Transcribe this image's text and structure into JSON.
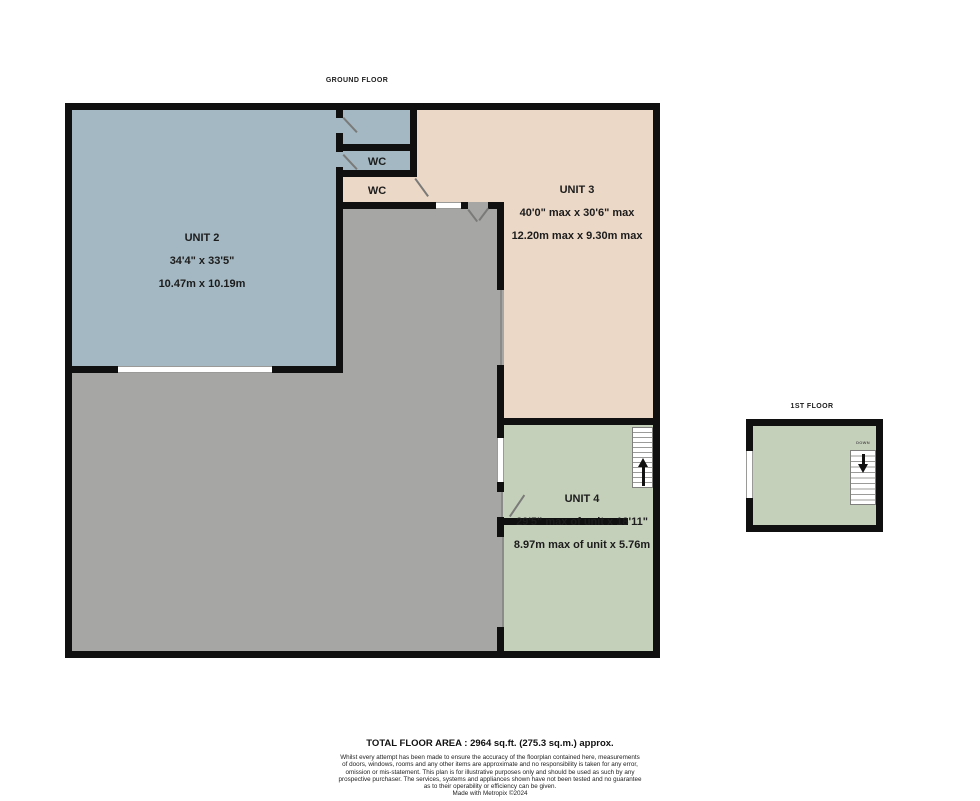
{
  "titles": {
    "ground_floor": "GROUND FLOOR",
    "first_floor": "1ST FLOOR"
  },
  "rooms": {
    "unit2": {
      "name": "UNIT 2",
      "dim_imperial": "34'4\" x 33'5\"",
      "dim_metric": "10.47m x 10.19m"
    },
    "unit3": {
      "name": "UNIT 3",
      "dim_imperial": "40'0\" max x 30'6\" max",
      "dim_metric": "12.20m max x 9.30m max"
    },
    "unit4": {
      "name": "UNIT 4",
      "dim_imperial": "29'5\" max of unit x 18'11\"",
      "dim_metric": "8.97m max of unit x 5.76m"
    },
    "wc1": {
      "name": "WC"
    },
    "wc2": {
      "name": "WC"
    }
  },
  "stairs": {
    "first_floor_direction": "DOWN"
  },
  "footer": {
    "total_area": "TOTAL FLOOR AREA : 2964 sq.ft. (275.3 sq.m.) approx.",
    "disclaimer": "Whilst every attempt has been made to ensure the accuracy of the floorplan contained here, measurements\nof doors, windows, rooms and any other items are approximate and no responsibility is taken for any error,\nomission or mis-statement. This plan is for illustrative purposes only and should be used as such by any\nprospective purchaser. The services, systems and appliances shown have not been tested and no guarantee\nas to their operability or efficiency can be given.",
    "credit": "Made with Metropix ©2024"
  },
  "colors": {
    "unit2_fill": "#a3b8c2",
    "unit3_fill": "#ecd8c7",
    "unit4_fill": "#c5d0bb",
    "open_area_fill": "#a6a6a4",
    "wall": "#101010",
    "background": "#ffffff"
  }
}
